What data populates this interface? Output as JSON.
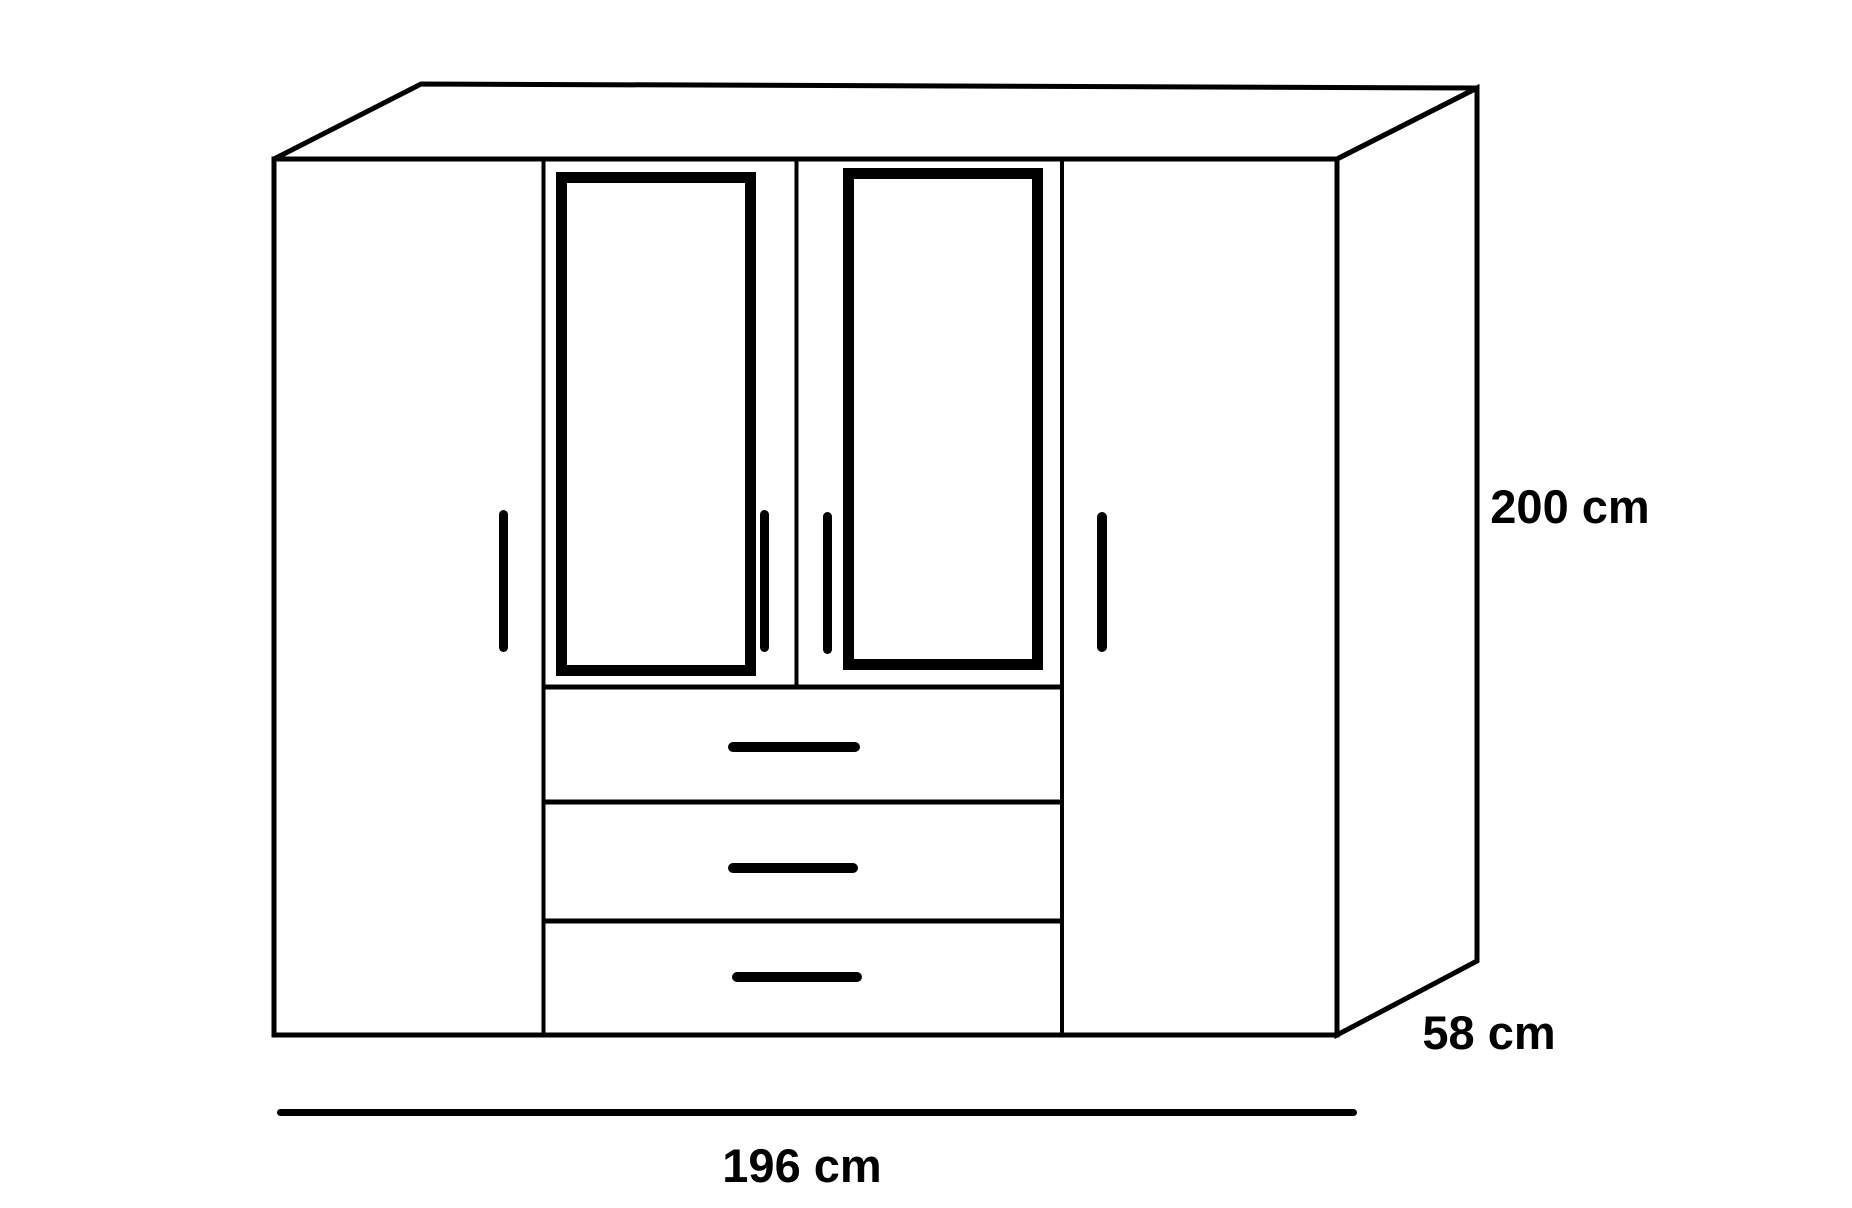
{
  "labels": {
    "height": "200 cm",
    "depth": "58 cm",
    "width": "196 cm"
  },
  "colors": {
    "line": "#000000",
    "background": "#ffffff"
  },
  "structure": {
    "door_count": 4,
    "mirrored_door_count": 2,
    "drawer_count": 3,
    "door_handle_count": 4,
    "drawer_handle_count": 3
  }
}
